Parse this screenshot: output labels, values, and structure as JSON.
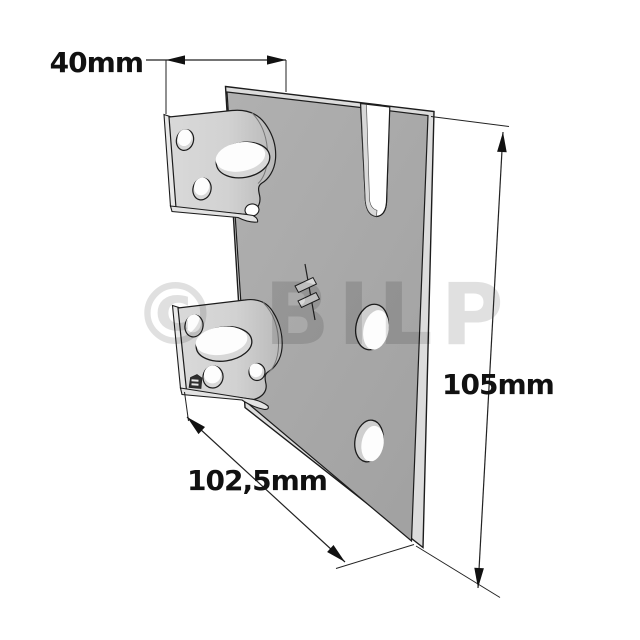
{
  "watermark": {
    "text": "© BILP",
    "color": "#000000",
    "opacity": "0.12"
  },
  "annotations": {
    "offset_depth": {
      "label": "40mm"
    },
    "height": {
      "label": "105mm"
    },
    "width": {
      "label": "102,5mm"
    }
  },
  "colors": {
    "background": "#ffffff",
    "plate_face": "#a9a9a9",
    "plate_edge": "#dcdcdc",
    "tab_face": "#d3d3d3",
    "tab_edge": "#e6e6e6",
    "hole_wall": "#cfcfcf",
    "hole_opening": "#fdfdfd",
    "outline": "#1c1c1c",
    "dimension": "#111111"
  }
}
